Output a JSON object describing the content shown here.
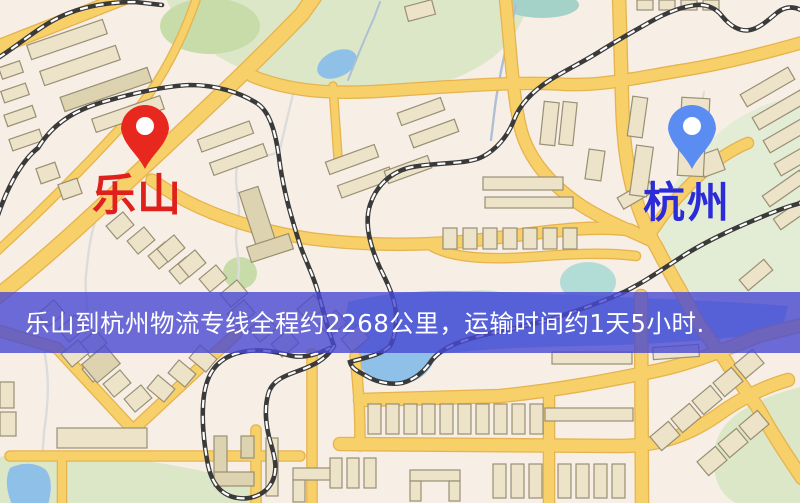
{
  "map": {
    "origin": {
      "label": "乐山"
    },
    "destination": {
      "label": "杭州"
    },
    "banner": {
      "text": "乐山到杭州物流专线全程约2268公里，运输时间约1天5小时."
    }
  },
  "icons": {
    "origin_pin": "red-map-pin",
    "destination_pin": "blue-map-pin"
  },
  "colors": {
    "background": "#f7efe6",
    "park": "#dce7c8",
    "park_dark": "#c8dcaa",
    "park_pale": "#e3ecd4",
    "park_cyan": "#b2ddd6",
    "water": "#8fc0e8",
    "water_teal": "#a5d2c8",
    "road": "#f7d06a",
    "road_casing": "#e6b34e",
    "building": "#ece3c8",
    "building_dark": "#ded3b0",
    "building_stroke": "#998f74",
    "rail": "#3a3a3a",
    "rail_dash": "#ffffff",
    "river": "#aebfd4",
    "path_line": "#dcdcdc",
    "origin_pin": "#e8281e",
    "destination_pin": "#5b8cf2",
    "origin_label": "#e0201a",
    "destination_label": "#2b2bd8",
    "banner_bg": "rgba(72,72,210,0.8)",
    "banner_text": "#ffffff"
  }
}
